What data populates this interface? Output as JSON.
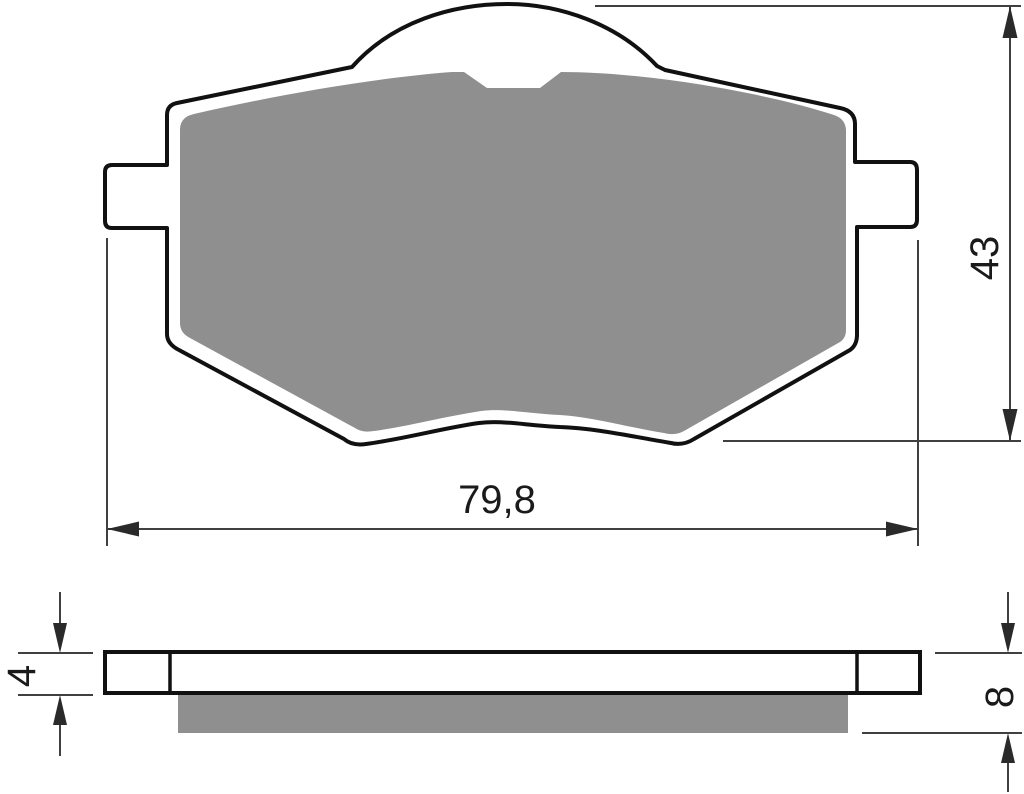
{
  "drawing": {
    "title": "brake-pad-technical-drawing",
    "views": {
      "front": {
        "name": "front-view",
        "dimensions": {
          "width": "79,8",
          "height": "43"
        }
      },
      "side": {
        "name": "side-view",
        "dimensions": {
          "backplate_thickness": "4",
          "total_thickness": "8"
        }
      }
    },
    "colors": {
      "background": "#ffffff",
      "outline": "#111111",
      "friction_material": "#8f8f8f",
      "dimension_line": "#404040",
      "dimension_text": "#1a1a1a"
    }
  }
}
